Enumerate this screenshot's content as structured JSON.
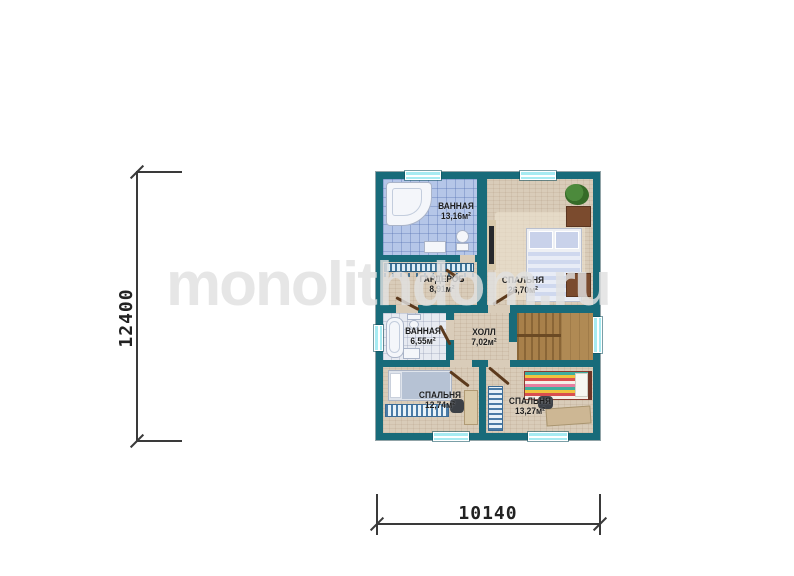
{
  "watermark": {
    "text": "monolithdom.ru"
  },
  "dimensions": {
    "vertical": "12400",
    "horizontal": "10140"
  },
  "rooms": [
    {
      "name": "ВАННАЯ",
      "area": "13,16м²"
    },
    {
      "name": "СПАЛЬНЯ",
      "area": "26,70м²"
    },
    {
      "name": "ГАРДЕРОБ",
      "area": "8,91м²"
    },
    {
      "name": "ВАННАЯ",
      "area": "6,55м²"
    },
    {
      "name": "ХОЛЛ",
      "area": "7,02м²"
    },
    {
      "name": "СПАЛЬНЯ",
      "area": "12,74м²"
    },
    {
      "name": "СПАЛЬНЯ",
      "area": "13,27м²"
    }
  ],
  "colors": {
    "wall": "#186b7a",
    "floor": "#d9ccb9",
    "bath_tile": "#b5c6e8",
    "bath_tile_pale": "#e7eaf1",
    "window": "#a6ebf2",
    "wood": "#a8804a",
    "furniture_brown": "#7b4b2e",
    "label_text": "#1d1d1d",
    "watermark": "#e0e0e0",
    "dimension": "#3a3a3a"
  }
}
